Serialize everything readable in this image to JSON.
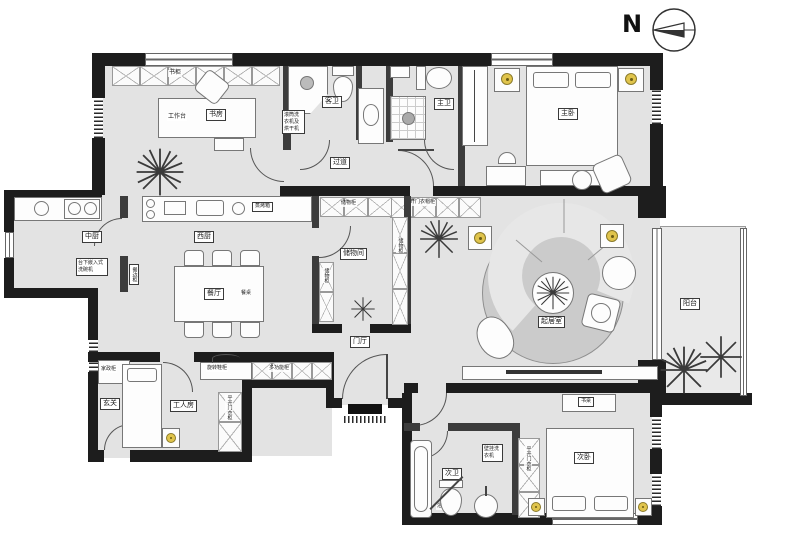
{
  "compass": {
    "label": "N"
  },
  "rooms": {
    "study": {
      "name": "书房",
      "worktable": "工作台",
      "bookshelf": "书柜"
    },
    "guest_bath": {
      "name": "客卫",
      "appliance_note": "滚筒洗衣机及烘干机"
    },
    "master_bath": {
      "name": "主卫"
    },
    "corridor": {
      "name": "过道",
      "wardrobe": "平开门衣帽柜"
    },
    "master_bedroom": {
      "name": "主卧"
    },
    "storage_room": {
      "name": "储物间",
      "cabinet": "储物柜"
    },
    "west_kitchen": {
      "name": "西厨",
      "oven": "蒸烤箱"
    },
    "chinese_kitchen": {
      "name": "中厨",
      "dishwasher_note": "台下嵌入式洗碗机",
      "sideboard": "餐边柜"
    },
    "dining": {
      "name": "餐厅",
      "table": "餐桌"
    },
    "living": {
      "name": "起居室"
    },
    "balcony": {
      "name": "阳台"
    },
    "entry": {
      "name": "玄关",
      "cabinet": "家政柜"
    },
    "maid_room": {
      "name": "工人房",
      "wardrobe": "平开门衣柜",
      "shoe_cabinet": "旋转鞋柜",
      "multi_cabinet": "多功能柜"
    },
    "foyer": {
      "name": "门厅"
    },
    "second_bath": {
      "name": "次卫",
      "bathtub": "浴缸",
      "washer_note": "壁挂洗衣机"
    },
    "second_bedroom": {
      "name": "次卧",
      "desk": "书桌",
      "wardrobe": "平开门衣柜"
    }
  },
  "colors": {
    "wall": "#1d1d1d",
    "floor": "#e3e3e3",
    "lamp": "#e0c44c",
    "rug": "#cccccc"
  }
}
